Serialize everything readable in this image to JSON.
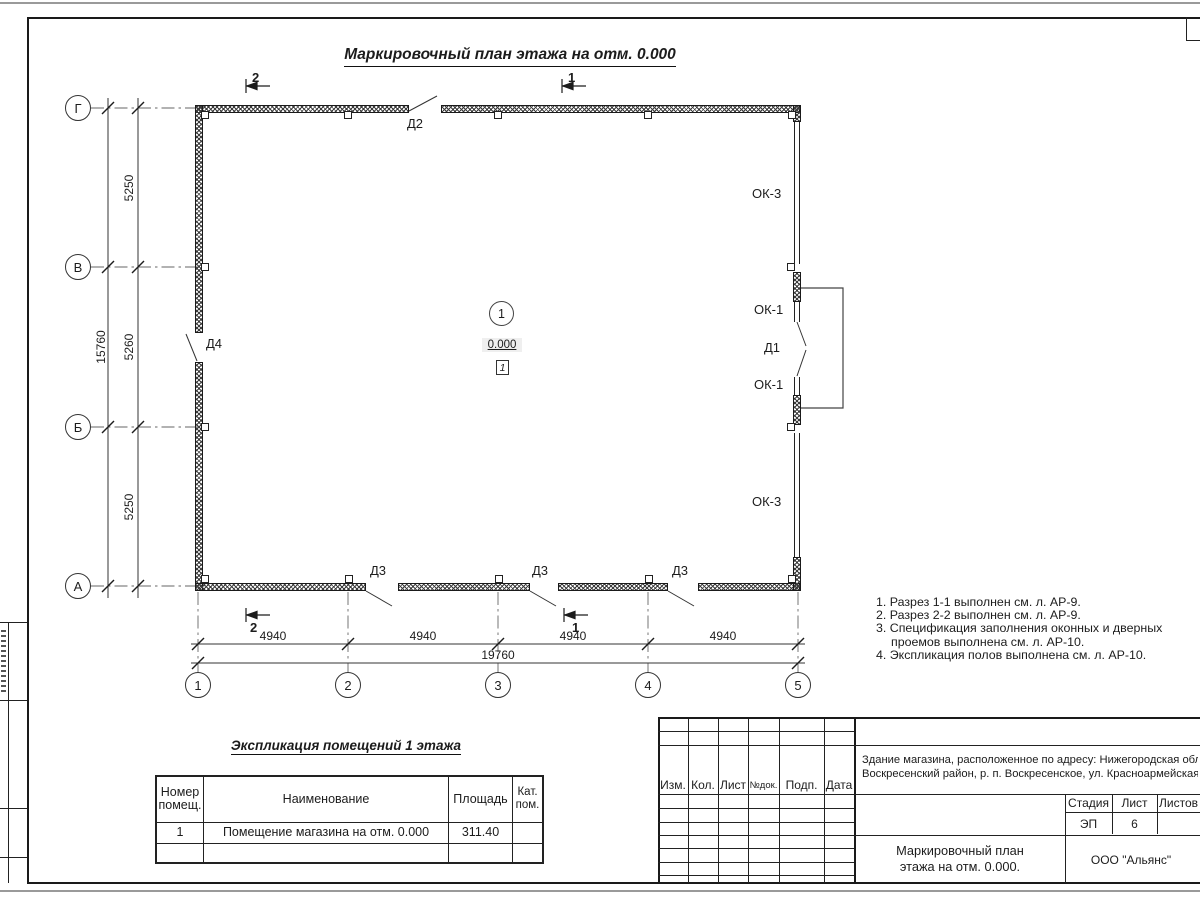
{
  "page": {
    "title": "Маркировочный план этажа на отм. 0.000"
  },
  "plan": {
    "axes_left": [
      "Г",
      "В",
      "Б",
      "А"
    ],
    "axes_bottom": [
      "1",
      "2",
      "3",
      "4",
      "5"
    ],
    "dims_left": [
      "5250",
      "5260",
      "5250"
    ],
    "dim_left_total": "15760",
    "dims_bottom": [
      "4940",
      "4940",
      "4940",
      "4940"
    ],
    "dim_bottom_total": "19760",
    "sections": {
      "s1": "1",
      "s2": "2"
    },
    "doors": {
      "d1": "Д1",
      "d2": "Д2",
      "d3": "Д3",
      "d4": "Д4"
    },
    "windows": {
      "ok1": "ОК-1",
      "ok3": "ОК-3"
    },
    "room": {
      "number": "1",
      "elevation": "0.000",
      "floor_mark": "1"
    }
  },
  "notes": [
    "1. Разрез 1-1 выполнен см. л. АР-9.",
    "2. Разрез 2-2 выполнен см. л. АР-9.",
    "3. Спецификация заполнения оконных и дверных",
    "проемов выполнена см. л. АР-10.",
    "4. Экспликация полов выполнена см. л. АР-10."
  ],
  "explication": {
    "title": "Экспликация помещений 1 этажа",
    "headers": {
      "num1": "Номер",
      "num2": "помещ.",
      "name": "Наименование",
      "area": "Площадь",
      "cat1": "Кат.",
      "cat2": "пом."
    },
    "rows": [
      {
        "num": "1",
        "name": "Помещение магазина на отм. 0.000",
        "area": "311.40",
        "cat": ""
      }
    ]
  },
  "stamp": {
    "header_cols": [
      "Изм.",
      "Кол.",
      "Лист",
      "№док.",
      "Подп.",
      "Дата"
    ],
    "object_line1": "Здание магазина, расположенное по адресу: Нижегородская область,",
    "object_line2": "Воскресенский район, р. п. Воскресенское, ул. Красноармейская, д. 1",
    "stage_label": "Стадия",
    "sheet_label": "Лист",
    "sheets_label": "Листов",
    "stage_value": "ЭП",
    "sheet_value": "6",
    "sheets_value": "",
    "doc_title_line1": "Маркировочный план",
    "doc_title_line2": "этажа на отм. 0.000.",
    "company": "ООО \"Альянс\""
  }
}
